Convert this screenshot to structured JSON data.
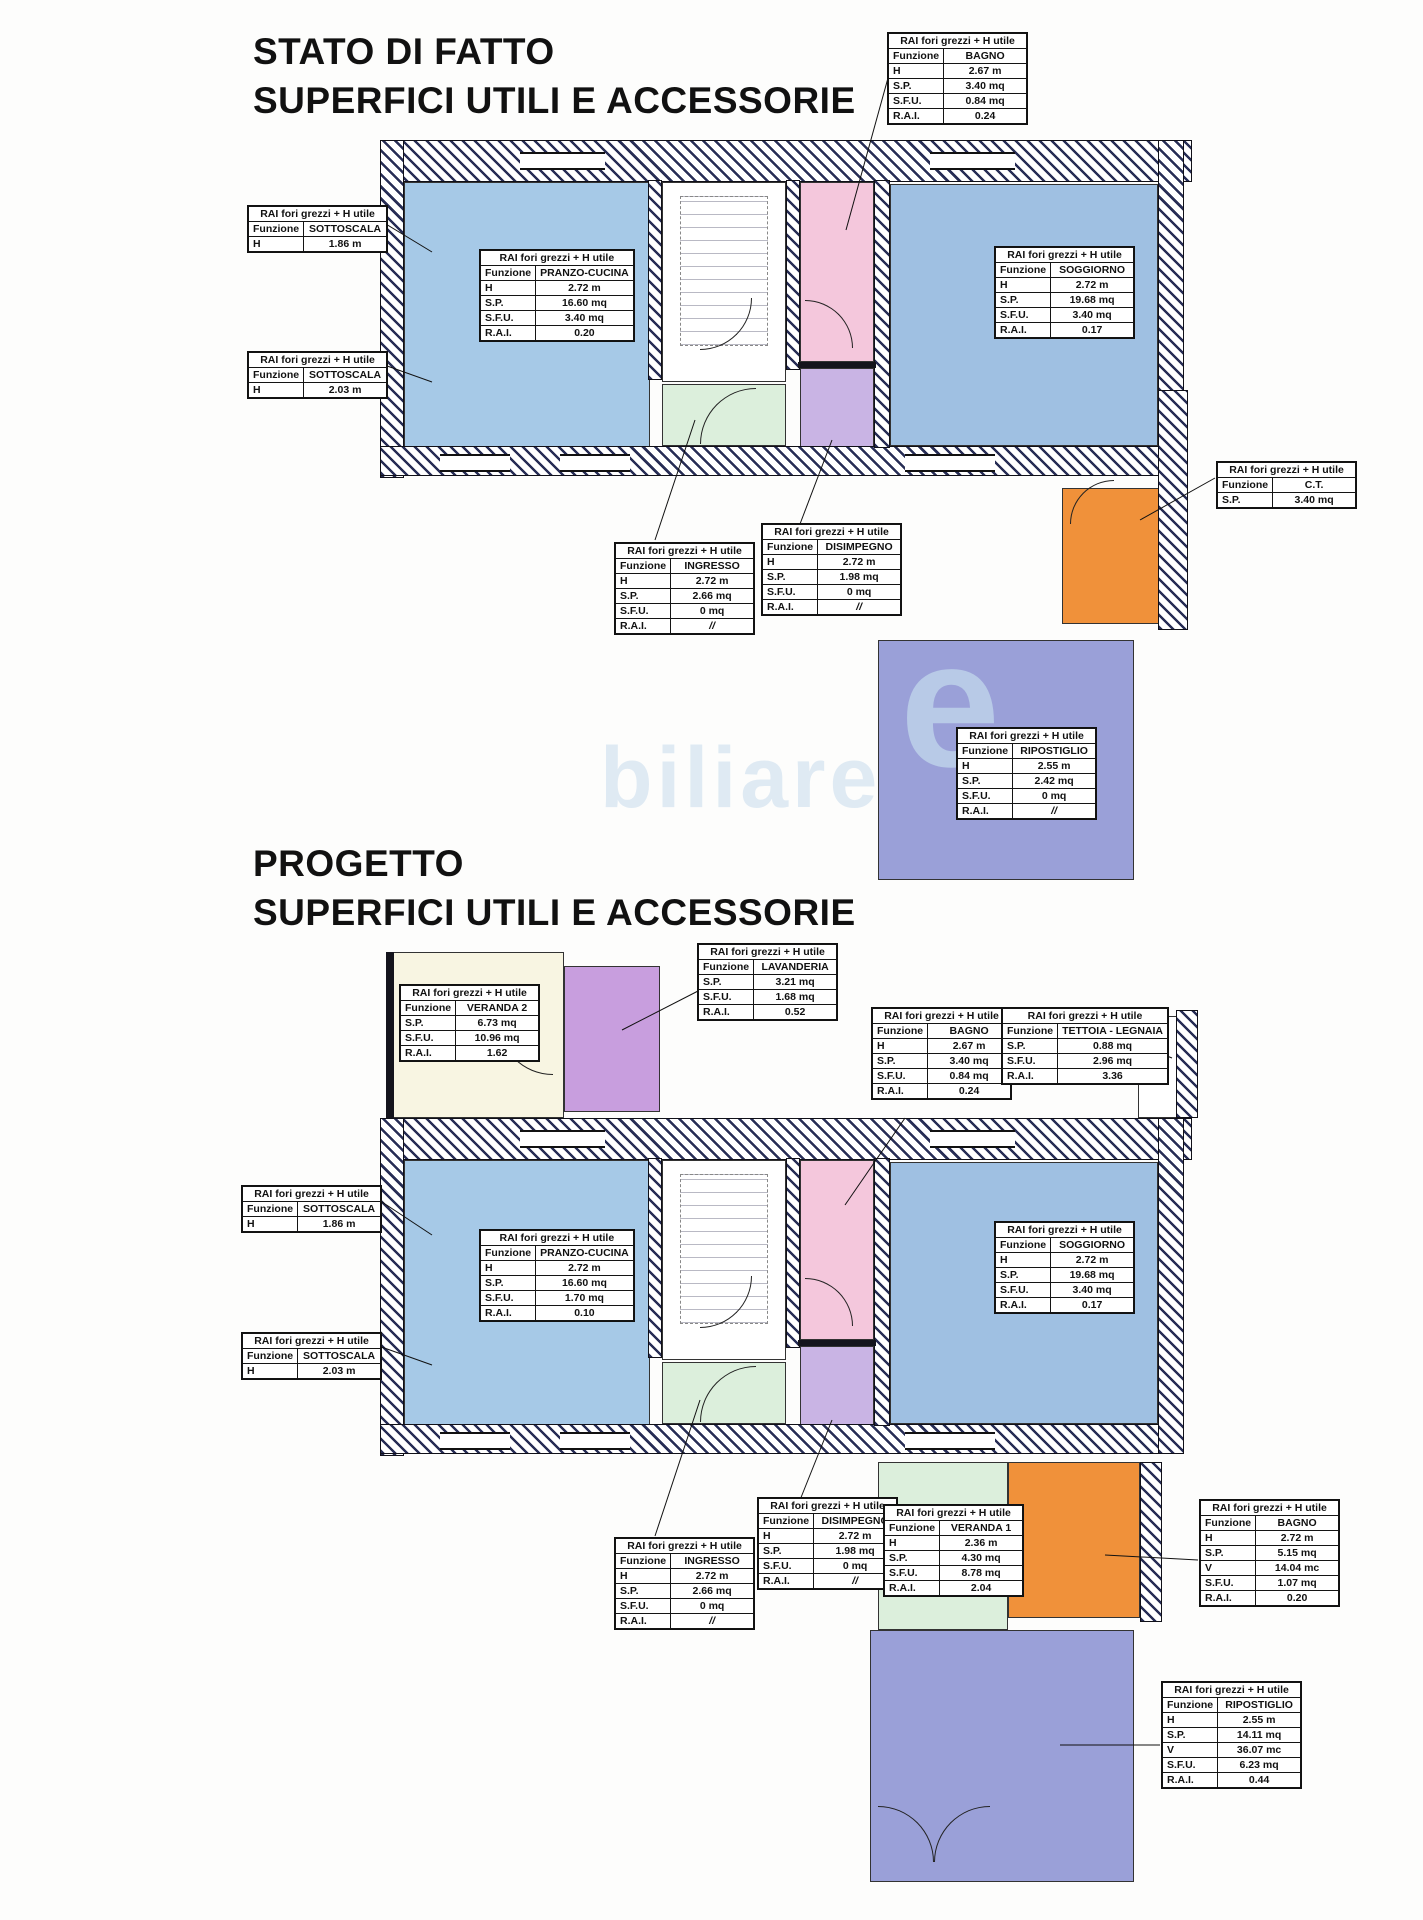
{
  "sections": {
    "stato": {
      "title_line1": "STATO DI FATTO",
      "title_line2": "SUPERFICI UTILI E ACCESSORIE"
    },
    "progetto": {
      "title_line1": "PROGETTO",
      "title_line2": "SUPERFICI UTILI E ACCESSORIE"
    }
  },
  "table_header": "RAI fori grezzi + H utile",
  "labels": {
    "funzione": "Funzione"
  },
  "tables": {
    "sdf_bagno_top": {
      "funzione": "BAGNO",
      "rows": [
        [
          "H",
          "2.67 m"
        ],
        [
          "S.P.",
          "3.40 mq"
        ],
        [
          "S.F.U.",
          "0.84 mq"
        ],
        [
          "R.A.I.",
          "0.24"
        ]
      ]
    },
    "sdf_sottoscala_1": {
      "funzione": "SOTTOSCALA",
      "rows": [
        [
          "H",
          "1.86 m"
        ]
      ]
    },
    "sdf_sottoscala_2": {
      "funzione": "SOTTOSCALA",
      "rows": [
        [
          "H",
          "2.03 m"
        ]
      ]
    },
    "sdf_pranzo": {
      "funzione": "PRANZO-CUCINA",
      "rows": [
        [
          "H",
          "2.72 m"
        ],
        [
          "S.P.",
          "16.60 mq"
        ],
        [
          "S.F.U.",
          "3.40 mq"
        ],
        [
          "R.A.I.",
          "0.20"
        ]
      ]
    },
    "sdf_soggiorno": {
      "funzione": "SOGGIORNO",
      "rows": [
        [
          "H",
          "2.72 m"
        ],
        [
          "S.P.",
          "19.68 mq"
        ],
        [
          "S.F.U.",
          "3.40 mq"
        ],
        [
          "R.A.I.",
          "0.17"
        ]
      ]
    },
    "sdf_ct": {
      "funzione": "C.T.",
      "rows": [
        [
          "S.P.",
          "3.40 mq"
        ]
      ]
    },
    "sdf_ingresso": {
      "funzione": "INGRESSO",
      "rows": [
        [
          "H",
          "2.72 m"
        ],
        [
          "S.P.",
          "2.66 mq"
        ],
        [
          "S.F.U.",
          "0 mq"
        ],
        [
          "R.A.I.",
          "//"
        ]
      ]
    },
    "sdf_disimpegno": {
      "funzione": "DISIMPEGNO",
      "rows": [
        [
          "H",
          "2.72 m"
        ],
        [
          "S.P.",
          "1.98 mq"
        ],
        [
          "S.F.U.",
          "0 mq"
        ],
        [
          "R.A.I.",
          "//"
        ]
      ]
    },
    "sdf_ripostiglio": {
      "funzione": "RIPOSTIGLIO",
      "rows": [
        [
          "H",
          "2.55 m"
        ],
        [
          "S.P.",
          "2.42 mq"
        ],
        [
          "S.F.U.",
          "0 mq"
        ],
        [
          "R.A.I.",
          "//"
        ]
      ]
    },
    "prg_veranda2": {
      "funzione": "VERANDA 2",
      "rows": [
        [
          "S.P.",
          "6.73 mq"
        ],
        [
          "S.F.U.",
          "10.96 mq"
        ],
        [
          "R.A.I.",
          "1.62"
        ]
      ]
    },
    "prg_lavanderia": {
      "funzione": "LAVANDERIA",
      "rows": [
        [
          "S.P.",
          "3.21 mq"
        ],
        [
          "S.F.U.",
          "1.68 mq"
        ],
        [
          "R.A.I.",
          "0.52"
        ]
      ]
    },
    "prg_bagno_mid": {
      "funzione": "BAGNO",
      "rows": [
        [
          "H",
          "2.67 m"
        ],
        [
          "S.P.",
          "3.40 mq"
        ],
        [
          "S.F.U.",
          "0.84 mq"
        ],
        [
          "R.A.I.",
          "0.24"
        ]
      ]
    },
    "prg_tettoia": {
      "funzione": "TETTOIA - LEGNAIA",
      "rows": [
        [
          "S.P.",
          "0.88 mq"
        ],
        [
          "S.F.U.",
          "2.96 mq"
        ],
        [
          "R.A.I.",
          "3.36"
        ]
      ]
    },
    "prg_sottoscala_1": {
      "funzione": "SOTTOSCALA",
      "rows": [
        [
          "H",
          "1.86 m"
        ]
      ]
    },
    "prg_sottoscala_2": {
      "funzione": "SOTTOSCALA",
      "rows": [
        [
          "H",
          "2.03 m"
        ]
      ]
    },
    "prg_pranzo": {
      "funzione": "PRANZO-CUCINA",
      "rows": [
        [
          "H",
          "2.72 m"
        ],
        [
          "S.P.",
          "16.60 mq"
        ],
        [
          "S.F.U.",
          "1.70 mq"
        ],
        [
          "R.A.I.",
          "0.10"
        ]
      ]
    },
    "prg_soggiorno": {
      "funzione": "SOGGIORNO",
      "rows": [
        [
          "H",
          "2.72 m"
        ],
        [
          "S.P.",
          "19.68 mq"
        ],
        [
          "S.F.U.",
          "3.40 mq"
        ],
        [
          "R.A.I.",
          "0.17"
        ]
      ]
    },
    "prg_ingresso": {
      "funzione": "INGRESSO",
      "rows": [
        [
          "H",
          "2.72 m"
        ],
        [
          "S.P.",
          "2.66 mq"
        ],
        [
          "S.F.U.",
          "0 mq"
        ],
        [
          "R.A.I.",
          "//"
        ]
      ]
    },
    "prg_disimpegno": {
      "funzione": "DISIMPEGNO",
      "rows": [
        [
          "H",
          "2.72 m"
        ],
        [
          "S.P.",
          "1.98 mq"
        ],
        [
          "S.F.U.",
          "0 mq"
        ],
        [
          "R.A.I.",
          "//"
        ]
      ]
    },
    "prg_veranda1": {
      "funzione": "VERANDA 1",
      "rows": [
        [
          "H",
          "2.36 m"
        ],
        [
          "S.P.",
          "4.30 mq"
        ],
        [
          "S.F.U.",
          "8.78 mq"
        ],
        [
          "R.A.I.",
          "2.04"
        ]
      ]
    },
    "prg_bagno_right": {
      "funzione": "BAGNO",
      "rows": [
        [
          "H",
          "2.72 m"
        ],
        [
          "S.P.",
          "5.15 mq"
        ],
        [
          "V",
          "14.04 mc"
        ],
        [
          "S.F.U.",
          "1.07 mq"
        ],
        [
          "R.A.I.",
          "0.20"
        ]
      ]
    },
    "prg_ripostiglio": {
      "funzione": "RIPOSTIGLIO",
      "rows": [
        [
          "H",
          "2.55 m"
        ],
        [
          "S.P.",
          "14.11 mq"
        ],
        [
          "V",
          "36.07 mc"
        ],
        [
          "S.F.U.",
          "6.23 mq"
        ],
        [
          "R.A.I.",
          "0.44"
        ]
      ]
    }
  },
  "colors": {
    "room_blue": "#a6c9e7",
    "room_blue2": "#9fc0e2",
    "room_pink": "#f4c7dc",
    "room_lilac": "#c9b4e4",
    "room_green": "#dcefdc",
    "room_orange": "#f0913a",
    "room_periwinkle": "#9aa0d8",
    "room_cream": "#f8f5e2",
    "room_purple": "#c89ede",
    "watermark_blue": "#c2d8ec"
  },
  "watermark": {
    "letter": "e",
    "text": "biliare"
  }
}
